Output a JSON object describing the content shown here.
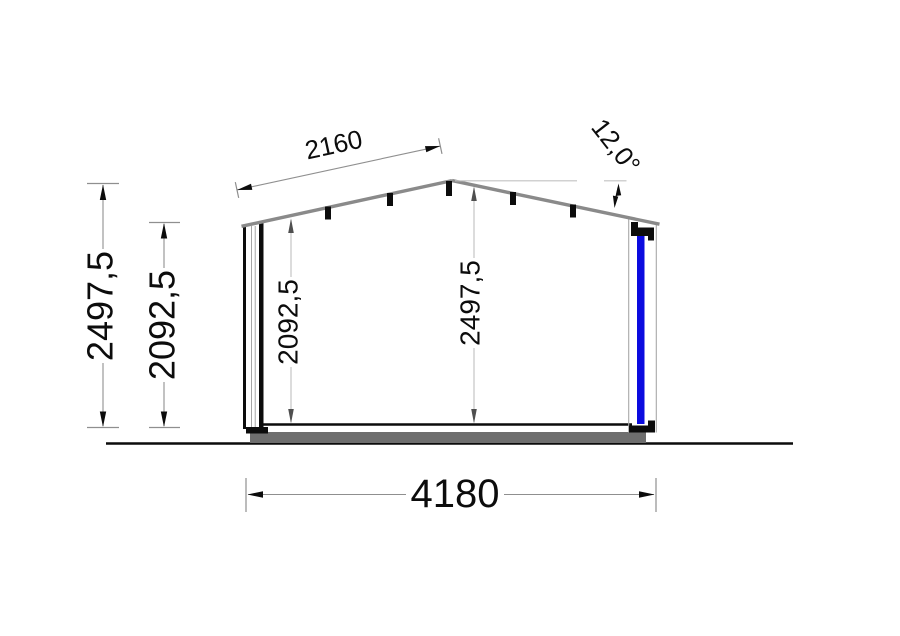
{
  "drawing": {
    "kind": "building cross-section elevation",
    "dimensions": {
      "slope_length": "2160",
      "roof_angle": "12,0°",
      "outer_height_left": "2497,5",
      "wall_height_left": "2092,5",
      "interior_wall_height": "2092,5",
      "interior_ridge_height": "2497,5",
      "overall_width": "4180"
    },
    "colors": {
      "glazing_blue": "#0b0bdf",
      "roof_gray": "#8a8a8a",
      "slab_gray": "#6e6e6e",
      "dim_line_gray": "#8f8f8f",
      "interior_dim_line_gray": "#b8b8b8",
      "interior_dim_arrow_gray": "#4f4f4f",
      "reference_line_gray": "#c2c2c2",
      "line_black": "#0c0c0c"
    }
  }
}
